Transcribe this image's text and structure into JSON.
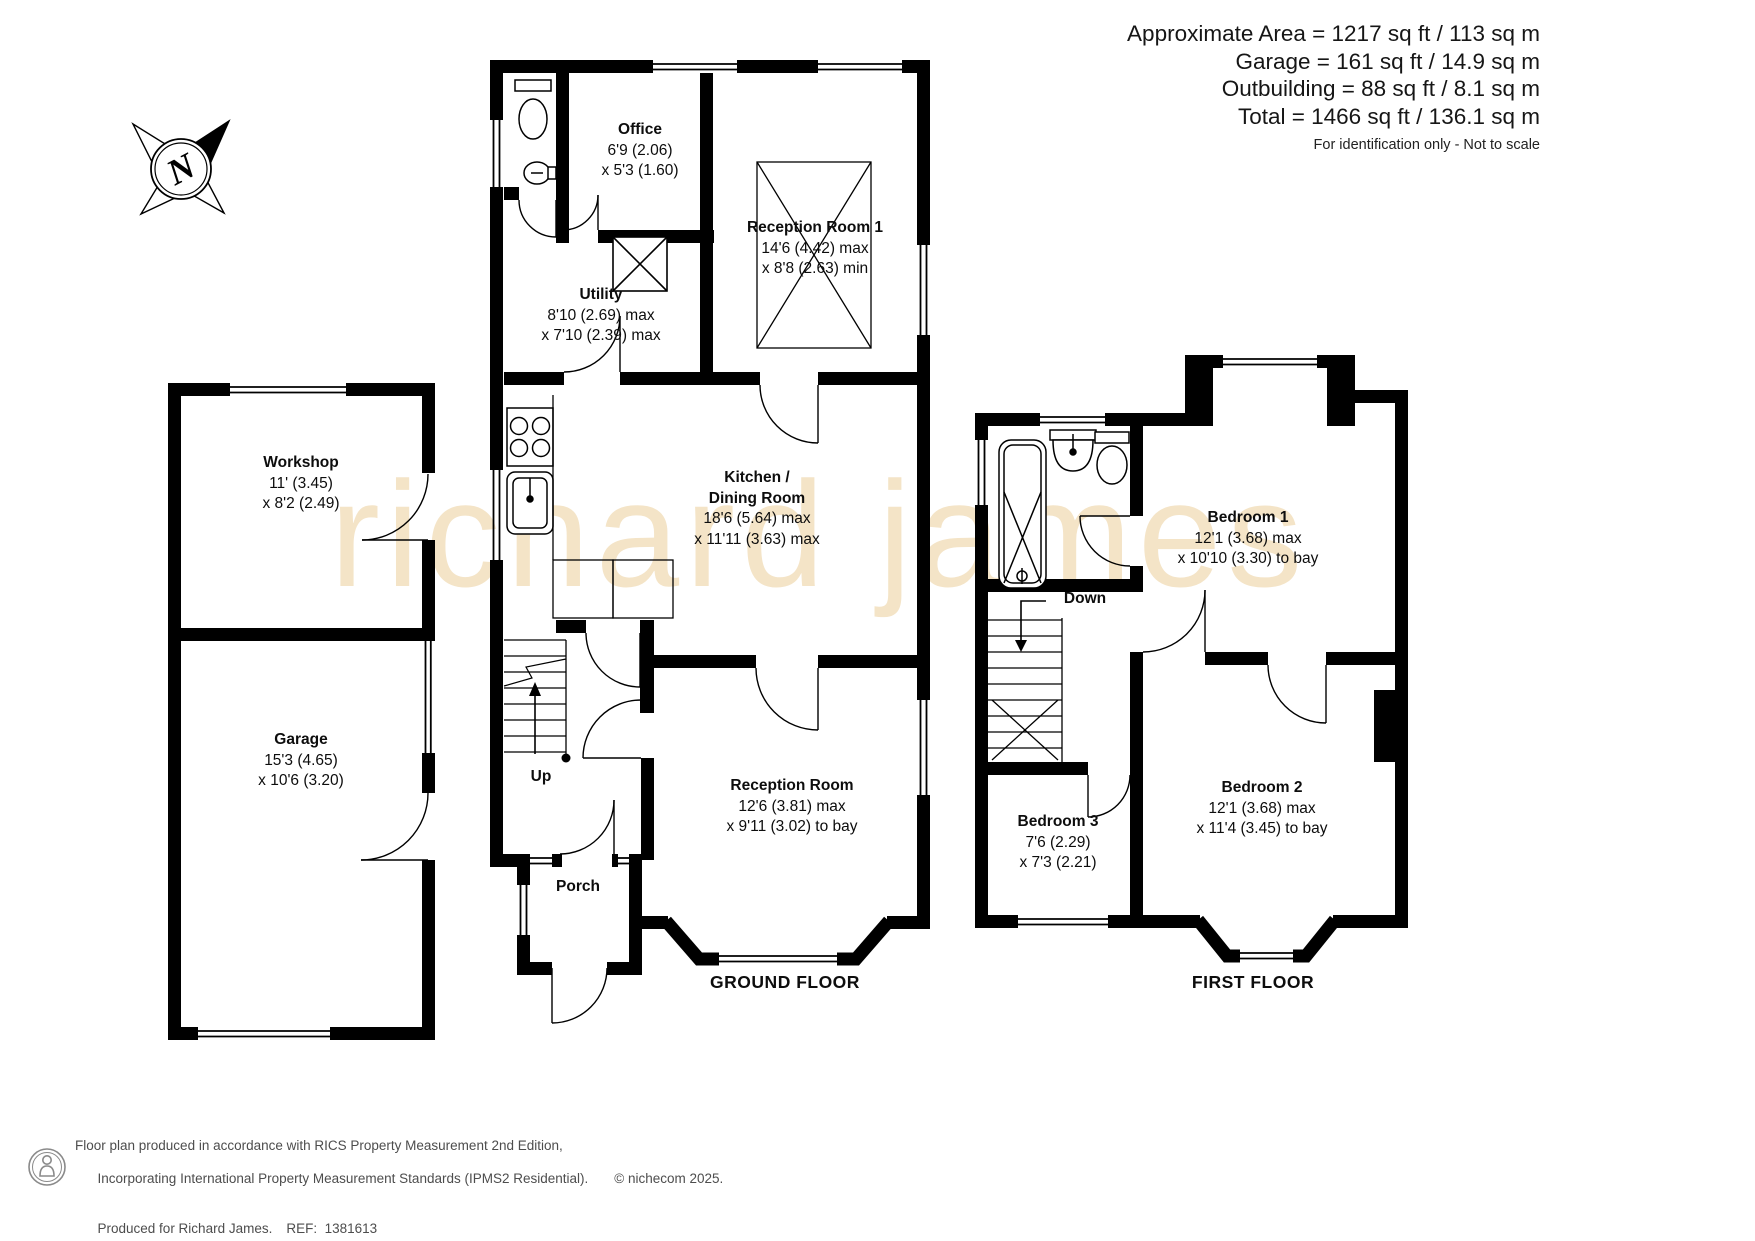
{
  "header": {
    "line1": "Approximate Area = 1217 sq ft / 113 sq m",
    "line2": "Garage = 161 sq ft / 14.9 sq m",
    "line3": "Outbuilding = 88 sq ft / 8.1 sq m",
    "line4": "Total = 1466 sq ft / 136.1 sq m",
    "disclaimer": "For identification only - Not to scale"
  },
  "compass": {
    "north": "N"
  },
  "watermark": "richard james",
  "floors": {
    "ground": {
      "title": "GROUND FLOOR"
    },
    "first": {
      "title": "FIRST FLOOR"
    }
  },
  "rooms": {
    "workshop": {
      "name": "Workshop",
      "dims": [
        "11' (3.45)",
        "x 8'2 (2.49)"
      ]
    },
    "garage": {
      "name": "Garage",
      "dims": [
        "15'3 (4.65)",
        "x 10'6 (3.20)"
      ]
    },
    "office": {
      "name": "Office",
      "dims": [
        "6'9 (2.06)",
        "x 5'3 (1.60)"
      ]
    },
    "utility": {
      "name": "Utility",
      "dims": [
        "8'10 (2.69) max",
        "x 7'10 (2.39) max"
      ]
    },
    "reception1": {
      "name": "Reception Room 1",
      "dims": [
        "14'6 (4.42) max",
        "x 8'8 (2.63) min"
      ]
    },
    "kitchen": {
      "name": "Kitchen /",
      "name2": "Dining Room",
      "dims": [
        "18'6 (5.64) max",
        "x 11'11 (3.63) max"
      ]
    },
    "reception": {
      "name": "Reception Room",
      "dims": [
        "12'6 (3.81) max",
        "x 9'11 (3.02) to bay"
      ]
    },
    "porch": {
      "name": "Porch"
    },
    "bedroom1": {
      "name": "Bedroom 1",
      "dims": [
        "12'1 (3.68) max",
        "x 10'10 (3.30) to bay"
      ]
    },
    "bedroom2": {
      "name": "Bedroom 2",
      "dims": [
        "12'1 (3.68) max",
        "x 11'4 (3.45) to bay"
      ]
    },
    "bedroom3": {
      "name": "Bedroom 3",
      "dims": [
        "7'6 (2.29)",
        "x 7'3 (2.21)"
      ]
    }
  },
  "stairs": {
    "up": "Up",
    "down": "Down"
  },
  "footer": {
    "line1": "Floor plan produced in accordance with RICS Property Measurement 2nd Edition,",
    "line2": "Incorporating International Property Measurement Standards (IPMS2 Residential).",
    "copyright": "© nichecom 2025.",
    "produced": "Produced for Richard James.",
    "ref": "REF:  1381613"
  }
}
